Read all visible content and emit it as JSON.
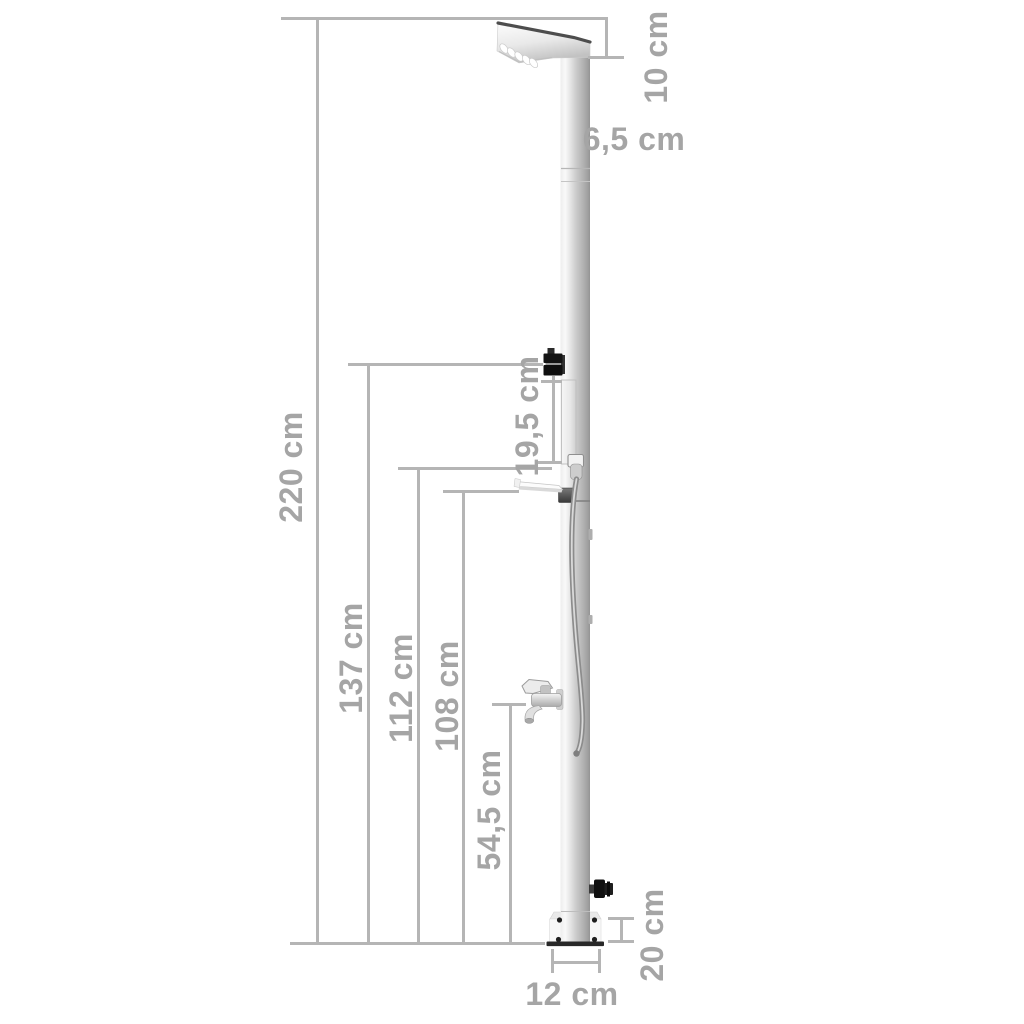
{
  "diagram": {
    "subject": "outdoor garden shower column, side-view dimension drawing",
    "unit": "cm",
    "labels": {
      "head_depth": "10 cm",
      "pole_width": "6,5 cm",
      "total_height": "220 cm",
      "panel_length": "19,5 cm",
      "mixer_height": "137 cm",
      "holder_height": "112 cm",
      "shelf_height": "108 cm",
      "tap_height": "54,5 cm",
      "base_plate": "20 cm",
      "base_width": "12 cm"
    },
    "colors": {
      "dimension_line": "#b5b5b5",
      "dimension_text": "#a5a5a5",
      "background": "#ffffff",
      "metal_light": "#f1f1f1",
      "metal_dark": "#949494",
      "fitting_black": "#141414"
    }
  }
}
